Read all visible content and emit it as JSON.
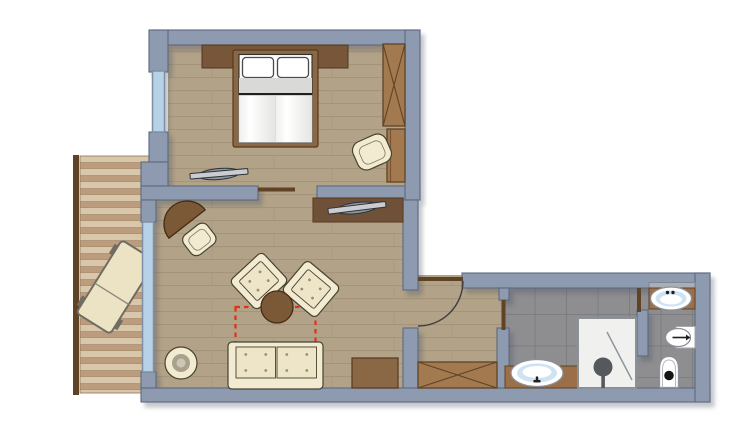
{
  "meta": {
    "kind": "architectural-floor-plan",
    "description": "Top-down floor plan of a suite: bedroom with double bed and wardrobe, living room with armchairs, sofa and TV consoles, wooden balcony with sun lounger, entrance hall with built-in closet, bathroom with vanity and shower, separate WC with washbasin, bidet and toilet"
  },
  "palette": {
    "wall": "#8d9aaf",
    "wallEdge": "#5b6a7f",
    "glass": "#b7d1e6",
    "glassFrame": "#7f90a4",
    "woodFloor": "#b2a288",
    "plankLine": "#968569",
    "balconyLight": "#d9c7ac",
    "balconyDark": "#bb9d7e",
    "balconyLine": "#8d7254",
    "railing": "#5e4325",
    "tile": "#8e8e91",
    "tileLine": "#7d7d81",
    "cream": "#f2ebd1",
    "creamInner": "#eee5c9",
    "creamEdge": "#47432f",
    "buttonDot": "#97906f",
    "bedFrame": "#8a6845",
    "bedFrameEdge": "#55391e",
    "headboard": "#775639",
    "walnut": "#a3794f",
    "walnutEdge": "#5f4426",
    "console": "#6e5138",
    "tableBrown": "#7b5836",
    "tableEdge": "#452c14",
    "mattress": "#fcfcfb",
    "sheet": "#d9d9d7",
    "ink": "#1f1f1f",
    "vanity": "#9b6f48",
    "basinBlue": "#cde2f2",
    "fixtureEdge": "#8b9199",
    "fixtureWhite": "#ffffff",
    "shower": "#f0f0ee",
    "showerDetail": "#55585c",
    "backsplash": "#a9afb6",
    "dashedRed": "#e0301e",
    "tvGray": "#c9cdd1",
    "tvOval": "#8f969c",
    "tvEdge": "#2e3237",
    "doorLeaf": "#5e4325",
    "arcStroke": "#3f3f3f",
    "loungerBody": "#ece3c4",
    "loungerFrame": "#716c63",
    "stoolMid": "#a9a190",
    "stoolCenter": "#ccc6b2"
  },
  "rooms": {
    "bedroom": {
      "label": "Bedroom",
      "furniture": [
        "headboard",
        "double bed",
        "two pillows",
        "x-front wardrobe",
        "tall cabinet",
        "armchair",
        "tv"
      ]
    },
    "living": {
      "label": "Living room",
      "furniture": [
        "tv console",
        "tv",
        "half-round table",
        "chair",
        "armchair",
        "armchair",
        "round coffee table",
        "two-seat sofa",
        "round stool",
        "lowboard",
        "red dashed zone"
      ]
    },
    "balcony": {
      "label": "Balcony",
      "furniture": [
        "wood deck",
        "railing",
        "sun lounger"
      ]
    },
    "hall": {
      "label": "Entrance hall",
      "furniture": [
        "entrance door",
        "built-in closet"
      ]
    },
    "bath": {
      "label": "Bathroom",
      "furniture": [
        "vanity with washbasin",
        "shower"
      ]
    },
    "wc": {
      "label": "WC",
      "furniture": [
        "washbasin",
        "bidet",
        "toilet"
      ]
    }
  }
}
